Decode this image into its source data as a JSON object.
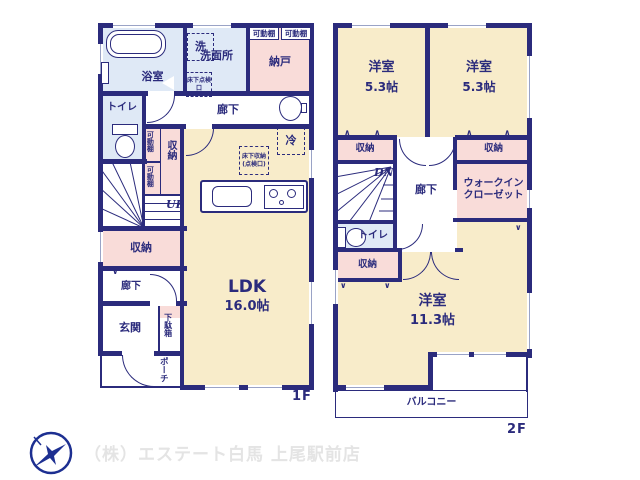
{
  "floor1": {
    "floor_label": "1F",
    "bath": "浴室",
    "laundry": "洗",
    "washroom": "洗面所",
    "underfloor_hatch": "床下点検口",
    "storeroom": "納戸",
    "movable_shelf": "可動棚",
    "hallway": "廊下",
    "toilet": "トイレ",
    "storage": "収納",
    "up": "UP",
    "fridge": "冷",
    "underfloor_storage": "床下収納(点検口)",
    "ldk_name": "LDK",
    "ldk_size": "16.0帖",
    "hallway2": "廊下",
    "entrance": "玄関",
    "shoe_cabinet": "下駄箱",
    "porch": "ポーチ"
  },
  "floor2": {
    "floor_label": "2F",
    "room1_name": "洋室",
    "room1_size": "5.3帖",
    "room2_name": "洋室",
    "room2_size": "5.3帖",
    "storage": "収納",
    "dn": "DN",
    "hallway": "廊下",
    "walk_in_closet": "ウォークインクローゼット",
    "toilet": "トイレ",
    "room3_name": "洋室",
    "room3_size": "11.3帖",
    "balcony": "バルコニー"
  },
  "footer": {
    "company": "（株）エステート白馬 上尾駅前店",
    "logo": "pegasus-bird-logo"
  },
  "colors": {
    "wall": "#2b2b7c",
    "room": "#f8ecca",
    "closet": "#f9dcd9",
    "wet_area": "#dfe9f6",
    "logo_blue": "#1d2f91",
    "footer_text": "#e4e4e4"
  }
}
